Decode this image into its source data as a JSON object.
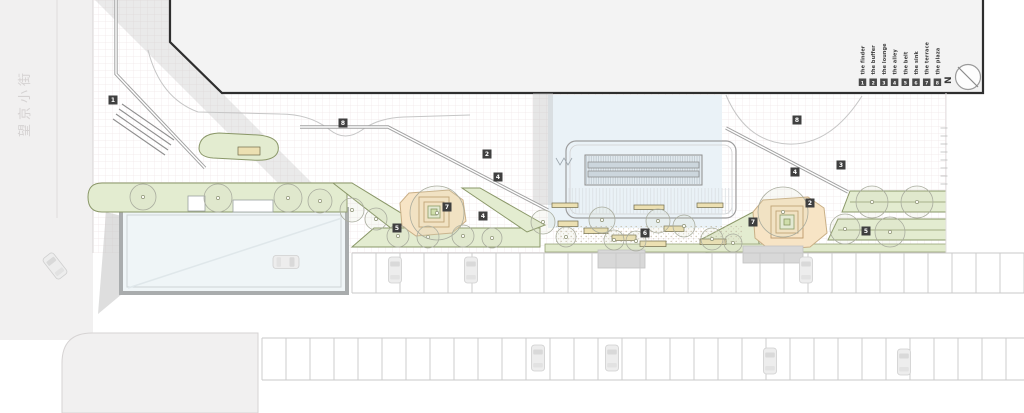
{
  "street": {
    "name": "望京小街"
  },
  "compass": {
    "label": "N"
  },
  "legend": {
    "items": [
      {
        "num": "1",
        "label": "the finder"
      },
      {
        "num": "2",
        "label": "the buffer"
      },
      {
        "num": "3",
        "label": "the lounge"
      },
      {
        "num": "4",
        "label": "the alley"
      },
      {
        "num": "5",
        "label": "the belt"
      },
      {
        "num": "6",
        "label": "the sink"
      },
      {
        "num": "7",
        "label": "the terrace"
      },
      {
        "num": "8",
        "label": "the plaza"
      }
    ]
  },
  "markers": [
    {
      "x": 113,
      "y": 100,
      "label": "1"
    },
    {
      "x": 343,
      "y": 123,
      "label": "8"
    },
    {
      "x": 487,
      "y": 154,
      "label": "2"
    },
    {
      "x": 498,
      "y": 177,
      "label": "4"
    },
    {
      "x": 447,
      "y": 207,
      "label": "7"
    },
    {
      "x": 483,
      "y": 216,
      "label": "4"
    },
    {
      "x": 397,
      "y": 228,
      "label": "5"
    },
    {
      "x": 645,
      "y": 233,
      "label": "6"
    },
    {
      "x": 797,
      "y": 120,
      "label": "8"
    },
    {
      "x": 795,
      "y": 172,
      "label": "4"
    },
    {
      "x": 841,
      "y": 165,
      "label": "3"
    },
    {
      "x": 810,
      "y": 203,
      "label": "2"
    },
    {
      "x": 753,
      "y": 222,
      "label": "7"
    },
    {
      "x": 866,
      "y": 231,
      "label": "5"
    }
  ],
  "trees": [
    [
      143,
      197,
      13
    ],
    [
      218,
      198,
      14
    ],
    [
      288,
      198,
      14
    ],
    [
      320,
      201,
      12
    ],
    [
      352,
      210,
      12
    ],
    [
      376,
      219,
      11
    ],
    [
      398,
      236,
      11
    ],
    [
      428,
      237,
      11
    ],
    [
      463,
      236,
      11
    ],
    [
      492,
      238,
      10
    ],
    [
      437,
      213,
      27
    ],
    [
      543,
      222,
      12
    ],
    [
      566,
      237,
      10
    ],
    [
      602,
      220,
      13
    ],
    [
      614,
      240,
      10
    ],
    [
      636,
      241,
      10
    ],
    [
      658,
      221,
      12
    ],
    [
      684,
      226,
      11
    ],
    [
      712,
      239,
      11
    ],
    [
      733,
      243,
      9
    ],
    [
      783,
      212,
      25
    ],
    [
      845,
      229,
      15
    ],
    [
      872,
      202,
      16
    ],
    [
      890,
      232,
      15
    ],
    [
      917,
      202,
      16
    ]
  ],
  "cars": [
    {
      "x": 55,
      "y": 266,
      "rot": -38
    },
    {
      "x": 286,
      "y": 262,
      "rot": 90
    },
    {
      "x": 395,
      "y": 270,
      "rot": 0
    },
    {
      "x": 471,
      "y": 270,
      "rot": 0
    },
    {
      "x": 806,
      "y": 270,
      "rot": 0
    },
    {
      "x": 538,
      "y": 358,
      "rot": 0
    },
    {
      "x": 612,
      "y": 358,
      "rot": 0
    },
    {
      "x": 770,
      "y": 361,
      "rot": 0
    },
    {
      "x": 904,
      "y": 362,
      "rot": 0
    }
  ],
  "parking": {
    "rows": [
      {
        "x0": 352,
        "x1": 1024,
        "y": 253,
        "depth": 40,
        "step": 24
      },
      {
        "x0": 262,
        "x1": 1024,
        "y": 338,
        "depth": 42,
        "step": 24
      }
    ]
  },
  "ticks": {
    "x": 944,
    "y0": 128,
    "step": 8,
    "count": 8
  },
  "colors": {
    "road-gray": "#f1f0f0",
    "grid-line": "#f0e6e8",
    "building-fill": "#f3f3f3",
    "building-stroke": "#2e2e2e",
    "shadow-gray": "#bdbdbd",
    "green-fill": "#e3ecd0",
    "green-stroke": "#8a9768",
    "hedge-fill": "#e1eacc",
    "orange-fill": "#f7e4c5",
    "orange-stroke": "#c9af86",
    "ring-stroke": "#bd9a6b",
    "glass-fill": "#eaf2f7",
    "glass-frame": "#a9acad",
    "bench-fill": "#ece0b2",
    "bench-stroke": "#6f6a49",
    "marker-bg": "#3f3f3f",
    "marker-fg": "#ffffff",
    "legend-bg": "#4a4a4a",
    "legend-fg": "#ffffff",
    "text-dark": "#3a3a3a",
    "path-gray": "#a3a3a3",
    "tree-stroke": "#a9ac9e",
    "street-text": "#d5d2d2"
  }
}
